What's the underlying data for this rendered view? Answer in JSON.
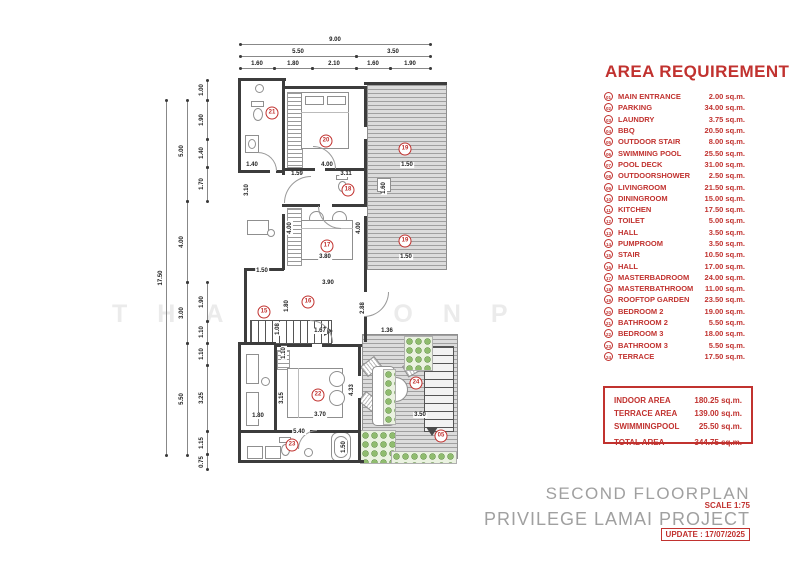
{
  "watermark": "THAWIMONP",
  "legend": {
    "title": "AREA REQUIREMENT",
    "rows": [
      {
        "num": "01",
        "label": "MAIN ENTRANCE",
        "area": "2.00 sq.m."
      },
      {
        "num": "02",
        "label": "PARKING",
        "area": "34.00 sq.m."
      },
      {
        "num": "03",
        "label": "LAUNDRY",
        "area": "3.75 sq.m."
      },
      {
        "num": "04",
        "label": "BBQ",
        "area": "20.50 sq.m."
      },
      {
        "num": "05",
        "label": "OUTDOOR STAIR",
        "area": "8.00 sq.m."
      },
      {
        "num": "06",
        "label": "SWIMMING POOL",
        "area": "25.50 sq.m."
      },
      {
        "num": "07",
        "label": "POOL DECK",
        "area": "31.00 sq.m."
      },
      {
        "num": "08",
        "label": "OUTDOORSHOWER",
        "area": "2.50 sq.m."
      },
      {
        "num": "09",
        "label": "LIVINGROOM",
        "area": "21.50 sq.m."
      },
      {
        "num": "10",
        "label": "DININGROOM",
        "area": "15.00 sq.m."
      },
      {
        "num": "11",
        "label": "KITCHEN",
        "area": "17.50 sq.m."
      },
      {
        "num": "12",
        "label": "TOILET",
        "area": "5.00 sq.m."
      },
      {
        "num": "13",
        "label": "HALL",
        "area": "3.50 sq.m."
      },
      {
        "num": "14",
        "label": "PUMPROOM",
        "area": "3.50 sq.m."
      },
      {
        "num": "15",
        "label": "STAIR",
        "area": "10.50 sq.m."
      },
      {
        "num": "16",
        "label": "HALL",
        "area": "17.00 sq.m."
      },
      {
        "num": "17",
        "label": "MASTERBADROOM",
        "area": "24.00 sq.m."
      },
      {
        "num": "18",
        "label": "MASTERBATHROOM",
        "area": "11.00 sq.m."
      },
      {
        "num": "19",
        "label": "ROOFTOP GARDEN",
        "area": "23.50 sq.m."
      },
      {
        "num": "20",
        "label": "BEDROOM 2",
        "area": "19.00 sq.m."
      },
      {
        "num": "21",
        "label": "BATHROOM 2",
        "area": "5.50 sq.m."
      },
      {
        "num": "22",
        "label": "BEDROOM 3",
        "area": "18.00 sq.m."
      },
      {
        "num": "23",
        "label": "BATHROOM 3",
        "area": "5.50 sq.m."
      },
      {
        "num": "24",
        "label": "TERRACE",
        "area": "17.50 sq.m."
      }
    ]
  },
  "summary": {
    "rows": [
      {
        "label": "INDOOR AREA",
        "value": "180.25 sq.m."
      },
      {
        "label": "TERRACE AREA",
        "value": "139.00 sq.m."
      },
      {
        "label": "SWIMMINGPOOL",
        "value": "25.50 sq.m."
      }
    ],
    "total": {
      "label": "TOTAL AREA",
      "value": "344.75 sq.m."
    }
  },
  "titleblock": {
    "plan_name": "SECOND FLOORPLAN",
    "scale": "SCALE 1:75",
    "project": "PRIVILEGE LAMAI PROJECT",
    "update": "UPDATE : 17/07/2025"
  },
  "colors": {
    "accent_red": "#c1322f",
    "title_gray": "#a0a0a0",
    "wall": "#3c3c3c",
    "deck_gray": "#dcdcdc",
    "plant_green": "#8fbc6e"
  },
  "plan": {
    "h_chains": [
      {
        "v": "9.00",
        "x1": 240,
        "x2": 430,
        "y": 44
      },
      {
        "v": "5.50",
        "x1": 240,
        "x2": 356,
        "y": 56
      },
      {
        "v": "3.50",
        "x1": 356,
        "x2": 430,
        "y": 56
      },
      {
        "v": "1.60",
        "x1": 240,
        "x2": 274,
        "y": 68
      },
      {
        "v": "1.80",
        "x1": 274,
        "x2": 312,
        "y": 68
      },
      {
        "v": "2.10",
        "x1": 312,
        "x2": 356,
        "y": 68
      },
      {
        "v": "1.60",
        "x1": 356,
        "x2": 390,
        "y": 68
      },
      {
        "v": "1.90",
        "x1": 390,
        "x2": 430,
        "y": 68
      }
    ],
    "v_chains": [
      {
        "v": "17.50",
        "x": 166,
        "y1": 100,
        "y2": 455
      },
      {
        "v": "5.00",
        "x": 187,
        "y1": 100,
        "y2": 201
      },
      {
        "v": "4.00",
        "x": 187,
        "y1": 201,
        "y2": 282
      },
      {
        "v": "3.00",
        "x": 187,
        "y1": 282,
        "y2": 343
      },
      {
        "v": "5.50",
        "x": 187,
        "y1": 343,
        "y2": 455
      },
      {
        "v": "1.00",
        "x": 207,
        "y1": 80,
        "y2": 100
      },
      {
        "v": "1.90",
        "x": 207,
        "y1": 100,
        "y2": 139
      },
      {
        "v": "1.40",
        "x": 207,
        "y1": 139,
        "y2": 167
      },
      {
        "v": "1.70",
        "x": 207,
        "y1": 167,
        "y2": 201
      },
      {
        "v": "1.90",
        "x": 207,
        "y1": 282,
        "y2": 321
      },
      {
        "v": "1.10",
        "x": 207,
        "y1": 321,
        "y2": 343
      },
      {
        "v": "1.10",
        "x": 207,
        "y1": 343,
        "y2": 365
      },
      {
        "v": "3.25",
        "x": 207,
        "y1": 365,
        "y2": 431
      },
      {
        "v": "1.15",
        "x": 207,
        "y1": 431,
        "y2": 454
      },
      {
        "v": "0.75",
        "x": 207,
        "y1": 454,
        "y2": 469
      }
    ],
    "room_dims": [
      {
        "v": "1.40",
        "x": 252,
        "y": 165,
        "r": 0
      },
      {
        "v": "4.00",
        "x": 327,
        "y": 165,
        "r": 0
      },
      {
        "v": "1.50",
        "x": 407,
        "y": 165,
        "r": 0
      },
      {
        "v": "1.59",
        "x": 297,
        "y": 174,
        "r": 0
      },
      {
        "v": "3.11",
        "x": 346,
        "y": 174,
        "r": 0
      },
      {
        "v": "1.60",
        "x": 384,
        "y": 188,
        "r": 1
      },
      {
        "v": "3.10",
        "x": 247,
        "y": 190,
        "r": 1
      },
      {
        "v": "4.00",
        "x": 290,
        "y": 228,
        "r": 1
      },
      {
        "v": "4.00",
        "x": 359,
        "y": 228,
        "r": 1
      },
      {
        "v": "3.80",
        "x": 325,
        "y": 257,
        "r": 0
      },
      {
        "v": "1.50",
        "x": 406,
        "y": 257,
        "r": 0
      },
      {
        "v": "1.50",
        "x": 262,
        "y": 271,
        "r": 0
      },
      {
        "v": "3.90",
        "x": 328,
        "y": 283,
        "r": 0
      },
      {
        "v": "1.80",
        "x": 287,
        "y": 306,
        "r": 1
      },
      {
        "v": "2.88",
        "x": 363,
        "y": 308,
        "r": 1
      },
      {
        "v": "1.08",
        "x": 278,
        "y": 329,
        "r": 1
      },
      {
        "v": "1.67",
        "x": 320,
        "y": 331,
        "r": 0
      },
      {
        "v": "1.36",
        "x": 387,
        "y": 331,
        "r": 0
      },
      {
        "v": "1.10",
        "x": 284,
        "y": 353,
        "r": 1
      },
      {
        "v": "3.15",
        "x": 282,
        "y": 398,
        "r": 1
      },
      {
        "v": "4.33",
        "x": 352,
        "y": 390,
        "r": 1
      },
      {
        "v": "1.80",
        "x": 258,
        "y": 416,
        "r": 0
      },
      {
        "v": "3.70",
        "x": 320,
        "y": 415,
        "r": 0
      },
      {
        "v": "3.50",
        "x": 420,
        "y": 415,
        "r": 0
      },
      {
        "v": "5.40",
        "x": 299,
        "y": 432,
        "r": 0
      },
      {
        "v": "1.50",
        "x": 344,
        "y": 447,
        "r": 1
      }
    ],
    "badges": [
      {
        "n": "21",
        "x": 272,
        "y": 113
      },
      {
        "n": "20",
        "x": 326,
        "y": 141
      },
      {
        "n": "19",
        "x": 405,
        "y": 149
      },
      {
        "n": "18",
        "x": 348,
        "y": 190
      },
      {
        "n": "17",
        "x": 327,
        "y": 246
      },
      {
        "n": "19",
        "x": 405,
        "y": 241
      },
      {
        "n": "16",
        "x": 308,
        "y": 302
      },
      {
        "n": "15",
        "x": 264,
        "y": 312
      },
      {
        "n": "22",
        "x": 318,
        "y": 395
      },
      {
        "n": "24",
        "x": 416,
        "y": 383
      },
      {
        "n": "05",
        "x": 441,
        "y": 436
      },
      {
        "n": "23",
        "x": 292,
        "y": 445
      }
    ]
  }
}
